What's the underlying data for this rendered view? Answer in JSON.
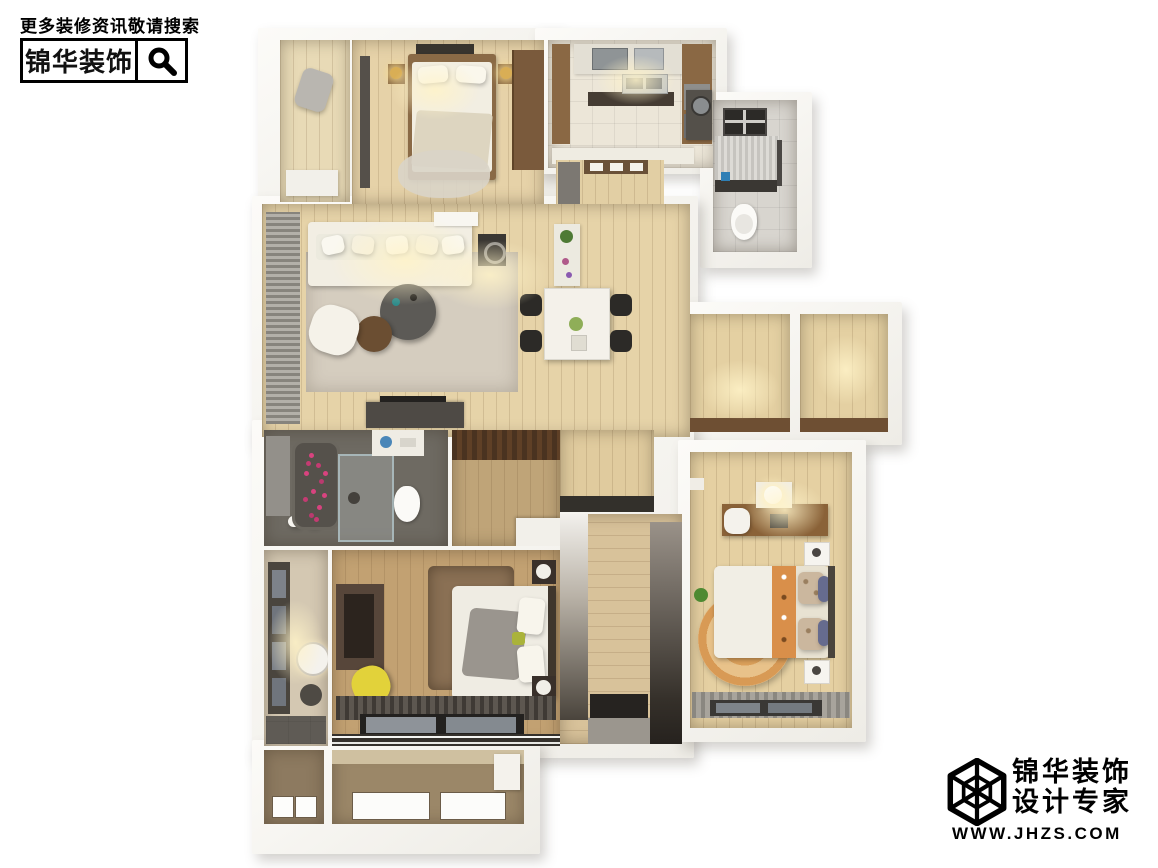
{
  "watermark": {
    "line1": "更多装修资讯敬请搜索",
    "brand": "锦华装饰",
    "icon": "search-icon"
  },
  "logo": {
    "brand": "锦华装饰",
    "tagline": "设计专家",
    "url": "WWW.JHZS.COM",
    "icon": "cube-logo-icon"
  },
  "palette": {
    "background": "#ffffff",
    "wall_white": "#f5f3ef",
    "wood_light": "#e6d2a8",
    "wood_mid": "#c2a172",
    "wood_dark": "#7a5a3c",
    "tile_beige": "#ece6d8",
    "tile_gray": "#d8d5cf",
    "bath_floor_dark": "#6e6a62",
    "rug_gray": "#d5cdbf",
    "rug_brown": "#8a7054",
    "rug_round_orange": "#dba05a",
    "accent_yellow": "#e2d23a",
    "accent_petal_pink": "#d8437f",
    "accent_blue": "#2f7fb5",
    "curtain_gray": "#8a8780",
    "furniture_dark": "#3a3733",
    "text_black": "#111111"
  },
  "floorplan": {
    "type": "3d-top-down-apartment-render",
    "rooms": [
      {
        "name": "balcony-top",
        "floor": "#e8dab6"
      },
      {
        "name": "master-bedroom-top",
        "floor": "#e6d2a8"
      },
      {
        "name": "kitchen",
        "floor": "#ece6d8"
      },
      {
        "name": "bathroom-top-right",
        "floor": "#d8d5cf"
      },
      {
        "name": "entry-hall",
        "floor": "#e2cfa4"
      },
      {
        "name": "living-dining-room",
        "floor": "#e6d3a8"
      },
      {
        "name": "storage-room-right-1",
        "floor": "#e4d0a2"
      },
      {
        "name": "storage-room-right-2",
        "floor": "#e4d0a2"
      },
      {
        "name": "bathroom-lower",
        "floor": "#6e6a62"
      },
      {
        "name": "walk-in-closet",
        "floor": "#bfa478"
      },
      {
        "name": "inner-room",
        "floor": "#e0cb9e"
      },
      {
        "name": "wardrobe-corridor",
        "floor": "#d8c29a"
      },
      {
        "name": "powder-room",
        "floor": "#d4c8b2"
      },
      {
        "name": "bedroom-lower-left",
        "floor": "#c2a172"
      },
      {
        "name": "bedroom-lower-right",
        "floor": "#e5d0a2"
      },
      {
        "name": "balcony-bottom-left",
        "floor": "#8d7a60"
      },
      {
        "name": "balcony-bottom-right",
        "floor": "#9b8768"
      }
    ]
  }
}
